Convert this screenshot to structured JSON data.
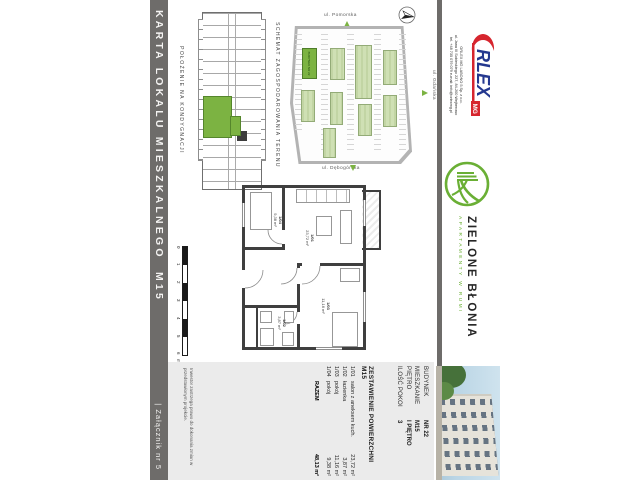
{
  "page": {
    "title": "KARTA LOKALU MIESZKALNEGO  M15",
    "attachment": "| Załącznik nr 5"
  },
  "developer": {
    "logo_text": "RLEX",
    "logo_badge": "MG",
    "address_lines": [
      "ORLEX MG LABONO 5 Sp. z o.o.",
      "ul. Jana III Sobieskiego 227, 84-200 Wejherowo",
      "tel. +48 735 079 079   e-mail: info@orlexmg.pl"
    ]
  },
  "brand": {
    "name": "ZIELONE BŁONIA",
    "tagline": "APARTAMENTY W RUMI"
  },
  "site_plan": {
    "caption": "SCHEMAT ZAGOSPODAROWANIA TERENU",
    "street_top": "ul. Gdańska",
    "street_left": "ul. Pomorska",
    "street_right": "ul. Dębogórska",
    "highlighted_building": "BUDYNEK NR 22"
  },
  "floor_plan": {
    "caption": "POŁOŻENIE NA KONDYGNACJI"
  },
  "scale_bar": {
    "ticks": [
      "0",
      "1",
      "2",
      "3",
      "4",
      "5",
      "6"
    ],
    "unit": "m"
  },
  "unit_info": {
    "rows": [
      {
        "label": "BUDYNEK",
        "value": "NR 22"
      },
      {
        "label": "MIESZKANIE",
        "value": "M15"
      },
      {
        "label": "PIĘTRO",
        "value": "I PIĘTRO"
      },
      {
        "label": "ILOŚĆ POKOI",
        "value": "3"
      }
    ]
  },
  "area_table": {
    "title": "ZESTAWIENIE POWIERZCHNI M15",
    "rows": [
      {
        "no": "1/01",
        "name": "salon z aneksem kuch.",
        "area": "23,72 m²"
      },
      {
        "no": "1/02",
        "name": "łazienka",
        "area": "3,87 m²"
      },
      {
        "no": "1/03",
        "name": "pokój",
        "area": "11,16 m²"
      },
      {
        "no": "1/04",
        "name": "pokój",
        "area": "9,38 m²"
      }
    ],
    "total_label": "RAZEM",
    "total": "48,13 m²"
  },
  "disclaimer": "Inwestor zastrzega prawo do dokonania zmian w przedstawionym projekcie.",
  "colors": {
    "accent_green": "#7CB342",
    "logo_green": "#6AAF35",
    "bar_gray": "#6E6C6A",
    "panel_gray": "#EBEBEB",
    "glex_red": "#D6252E",
    "glex_blue": "#24388F"
  }
}
